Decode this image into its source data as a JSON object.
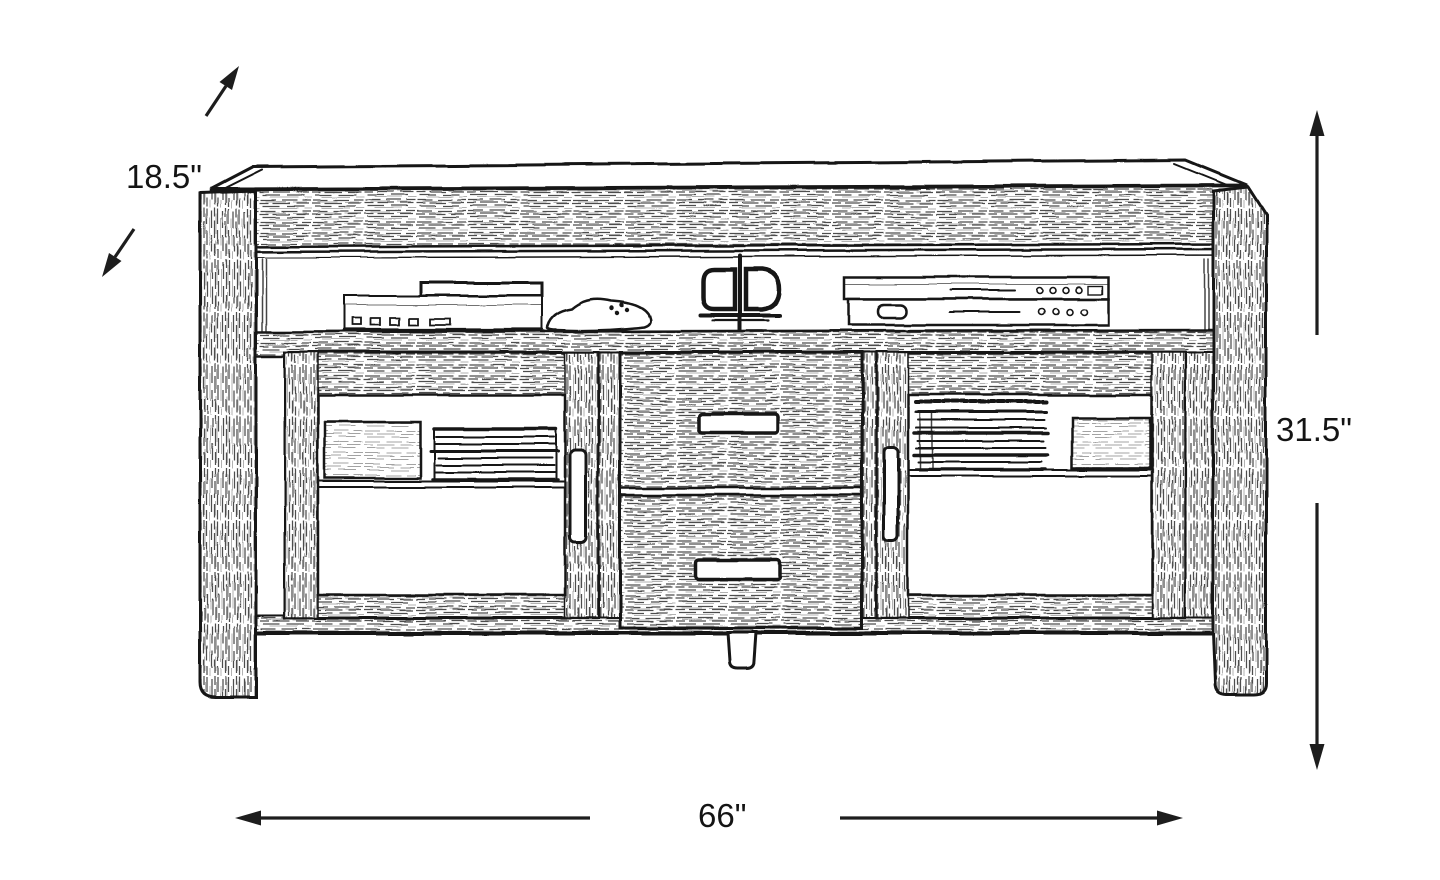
{
  "diagram": {
    "type": "furniture-dimension-sketch",
    "subject": "TV console sketch with two glass doors, two center drawers and open media shelf",
    "dimension_labels": {
      "depth": "18.5\"",
      "height": "31.5\"",
      "width": "66\""
    },
    "colors": {
      "ink": "#161616",
      "paper": "#ffffff"
    },
    "icons": [
      "depth-arrow-up-icon",
      "depth-arrow-down-icon",
      "height-arrow-up-icon",
      "height-arrow-down-icon",
      "width-arrow-left-icon",
      "width-arrow-right-icon",
      "dvd-player-icon",
      "game-controller-icon",
      "headphones-icon",
      "av-receiver-stack-icon"
    ]
  }
}
